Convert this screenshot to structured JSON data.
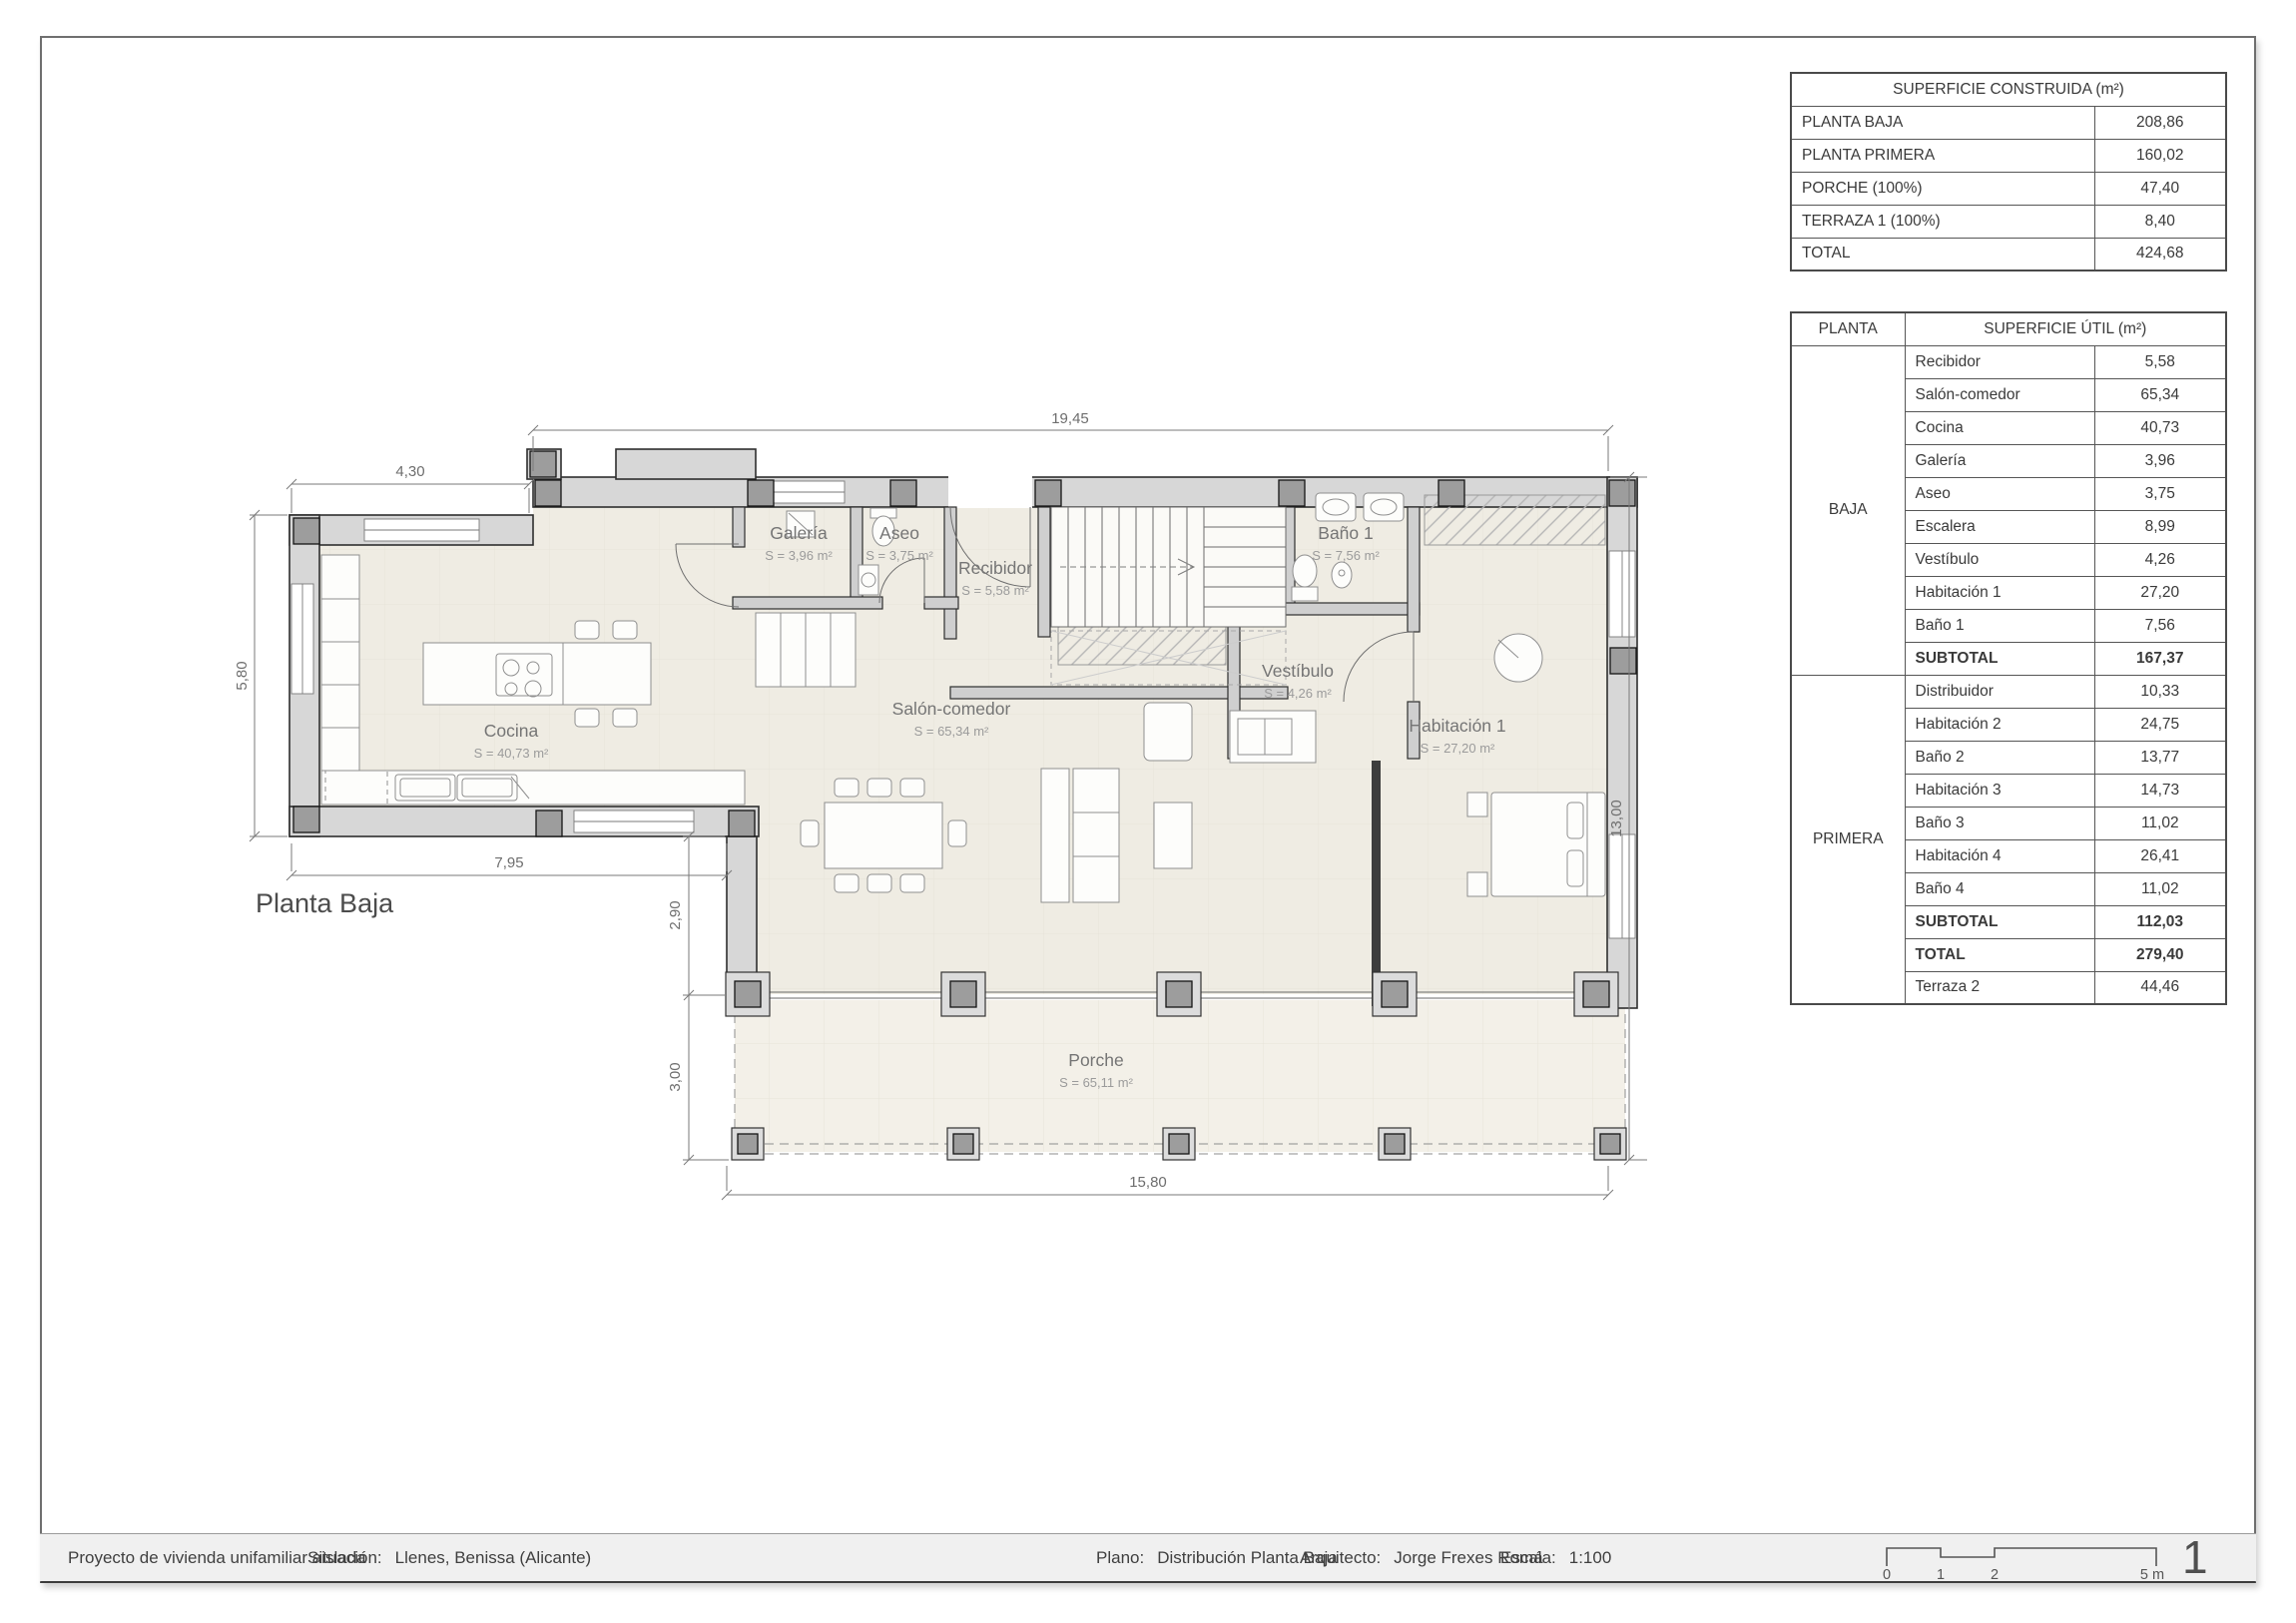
{
  "page_number": "1",
  "tables": {
    "construida": {
      "title": "SUPERFICIE CONSTRUIDA (m²)",
      "rows": [
        {
          "label": "PLANTA BAJA",
          "value": "208,86"
        },
        {
          "label": "PLANTA PRIMERA",
          "value": "160,02"
        },
        {
          "label": "PORCHE (100%)",
          "value": "47,40"
        },
        {
          "label": "TERRAZA 1 (100%)",
          "value": "8,40"
        },
        {
          "label": "TOTAL",
          "value": "424,68"
        }
      ]
    },
    "util": {
      "header": {
        "col1": "PLANTA",
        "col2": "SUPERFICIE ÚTIL (m²)"
      },
      "baja": {
        "name": "BAJA",
        "rows": [
          {
            "label": "Recibidor",
            "value": "5,58"
          },
          {
            "label": "Salón-comedor",
            "value": "65,34"
          },
          {
            "label": "Cocina",
            "value": "40,73"
          },
          {
            "label": "Galería",
            "value": "3,96"
          },
          {
            "label": "Aseo",
            "value": "3,75"
          },
          {
            "label": "Escalera",
            "value": "8,99"
          },
          {
            "label": "Vestíbulo",
            "value": "4,26"
          },
          {
            "label": "Habitación 1",
            "value": "27,20"
          },
          {
            "label": "Baño 1",
            "value": "7,56"
          },
          {
            "label": "SUBTOTAL",
            "value": "167,37"
          }
        ]
      },
      "primera": {
        "name": "PRIMERA",
        "rows": [
          {
            "label": "Distribuidor",
            "value": "10,33"
          },
          {
            "label": "Habitación 2",
            "value": "24,75"
          },
          {
            "label": "Baño 2",
            "value": "13,77"
          },
          {
            "label": "Habitación 3",
            "value": "14,73"
          },
          {
            "label": "Baño 3",
            "value": "11,02"
          },
          {
            "label": "Habitación 4",
            "value": "26,41"
          },
          {
            "label": "Baño 4",
            "value": "11,02"
          },
          {
            "label": "SUBTOTAL",
            "value": "112,03"
          },
          {
            "label": "TOTAL",
            "value": "279,40"
          },
          {
            "label": "Terraza 2",
            "value": "44,46"
          }
        ]
      }
    }
  },
  "plan": {
    "title": "Planta Baja",
    "rooms": {
      "galeria": {
        "name": "Galería",
        "area": "S = 3,96 m²"
      },
      "aseo": {
        "name": "Aseo",
        "area": "S = 3,75 m²"
      },
      "recibidor": {
        "name": "Recibidor",
        "area": "S = 5,58 m²"
      },
      "bano1": {
        "name": "Baño 1",
        "area": "S = 7,56 m²"
      },
      "vestibulo": {
        "name": "Vestíbulo",
        "area": "S = 4,26 m²"
      },
      "habitacion1": {
        "name": "Habitación 1",
        "area": "S = 27,20 m²"
      },
      "cocina": {
        "name": "Cocina",
        "area": "S = 40,73 m²"
      },
      "salon": {
        "name": "Salón-comedor",
        "area": "S = 65,34 m²"
      },
      "porche": {
        "name": "Porche",
        "area": "S = 65,11 m²"
      }
    },
    "dimensions": {
      "top": "19,45",
      "left_upper": "4,30",
      "left": "5,80",
      "bottom_left": "7,95",
      "left_mid": "2,90",
      "left_lower": "3,00",
      "bottom": "15,80",
      "right": "13,00"
    }
  },
  "footer": {
    "project": "Proyecto de vivienda unifamiliar aislada",
    "situacion_label": "Situación:",
    "situacion": "Llenes, Benissa (Alicante)",
    "plano_label": "Plano:",
    "plano": "Distribución Planta Baja",
    "arquitecto_label": "Arquitecto:",
    "arquitecto": "Jorge Frexes Romá",
    "escala_label": "Escala:",
    "escala": "1:100",
    "scalebar": [
      "0",
      "1",
      "2",
      "5 m"
    ]
  }
}
